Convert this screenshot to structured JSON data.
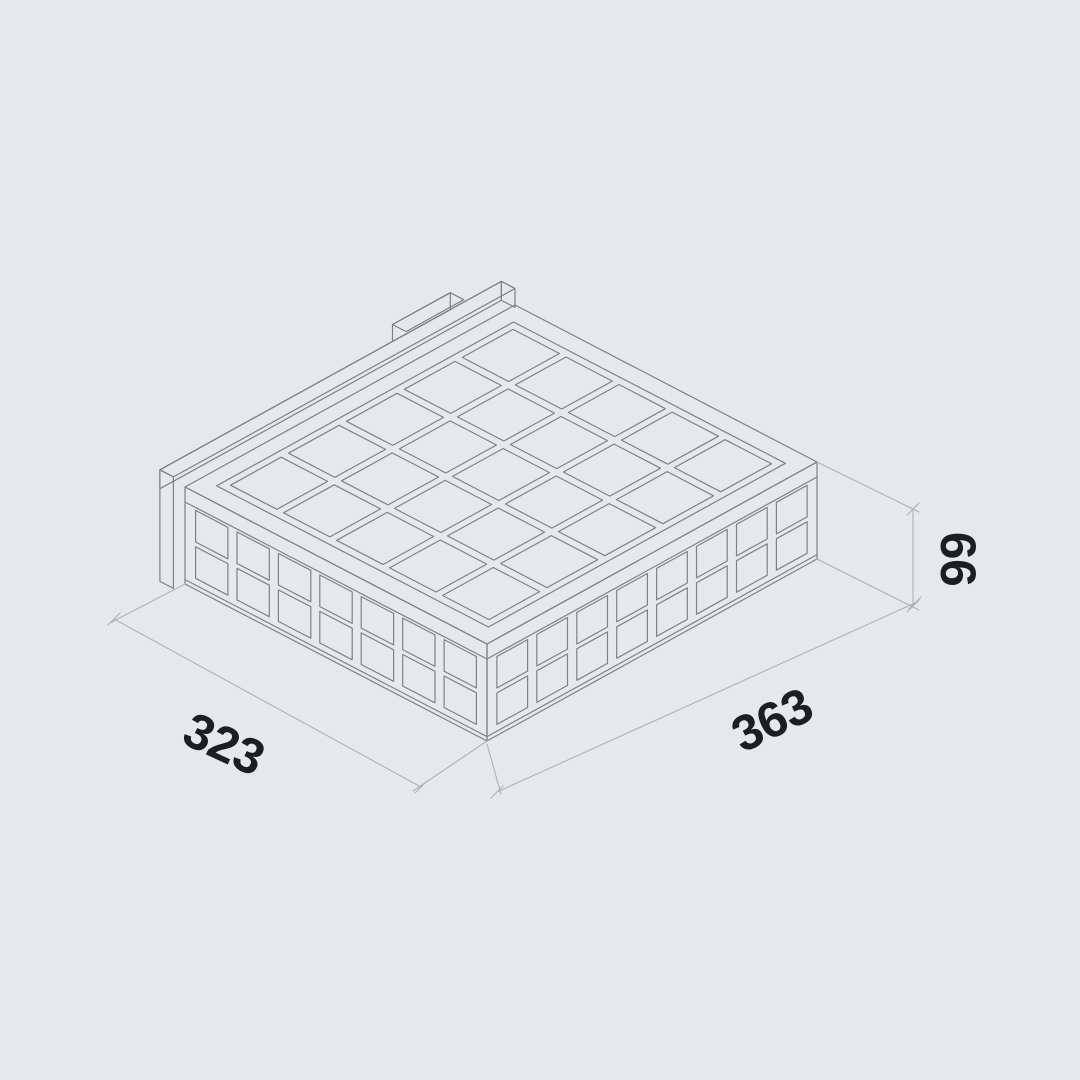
{
  "drawing": {
    "title": "isometric-grid-box-dimension-drawing",
    "background_color": "#e6e9ec",
    "line_color": "#7c8287",
    "dim_line_color": "#acb2b7",
    "text_color": "#1c1e20",
    "face_color": "#f4f6f8",
    "dimensions": {
      "depth_label": "323",
      "width_label": "363",
      "height_label": "66"
    },
    "grids": {
      "top": {
        "cols": 5,
        "rows": 5
      },
      "left_face": {
        "cols": 7,
        "rows": 2
      },
      "right_face": {
        "cols": 8,
        "rows": 2
      }
    }
  }
}
